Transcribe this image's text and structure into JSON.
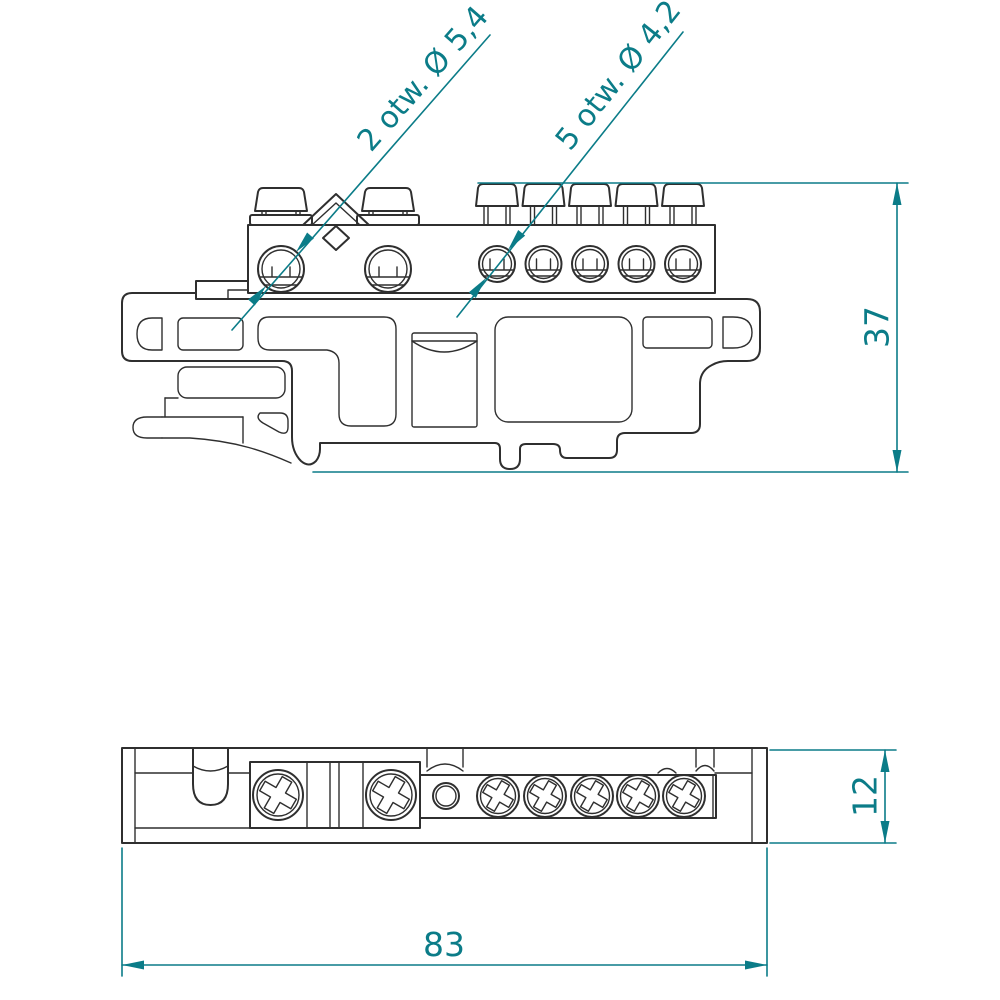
{
  "colors": {
    "ink": "#2f2f2f",
    "accent": "#0b7c88",
    "background": "#ffffff"
  },
  "annotations": {
    "large_holes_label": "2 otw. Ø 5,4",
    "small_holes_label": "5 otw. Ø 4,2"
  },
  "dimensions": {
    "side_view_height": "37",
    "plan_view_height": "12",
    "plan_view_width": "83"
  }
}
